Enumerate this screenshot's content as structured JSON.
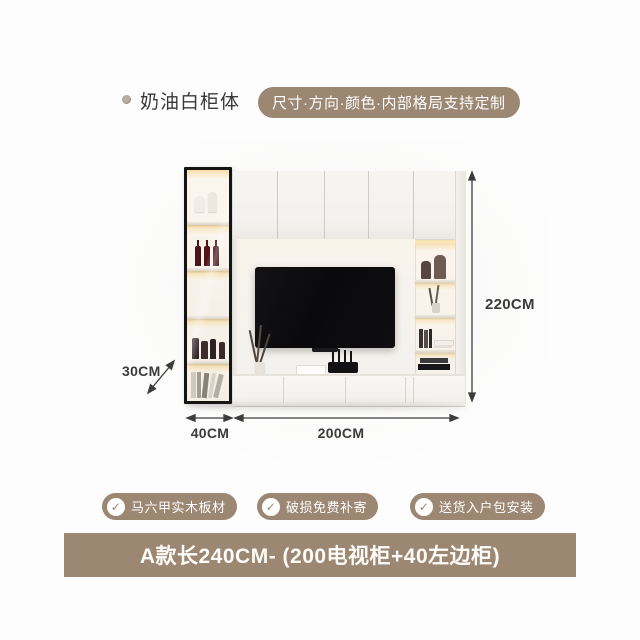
{
  "colors": {
    "accent_taupe": "#9C8773",
    "text_dark": "#3A3A3A",
    "cabinet_white": "#F6F3EE",
    "tv_black": "#0B0B0D",
    "led_glow": "#F7E0A6"
  },
  "header": {
    "product_label": "奶油白柜体",
    "customize_badge": "尺寸·方向·颜色·内部格局支持定制"
  },
  "figure": {
    "dim_height": "220CM",
    "dim_depth": "30CM",
    "dim_left_cabinet_width": "40CM",
    "dim_tv_cabinet_width": "200CM"
  },
  "features": [
    "马六甲实木板材",
    "破损免费补寄",
    "送货入户包安装"
  ],
  "icons": {
    "check": "✓",
    "bullet": "dot"
  },
  "footer": {
    "variant_title": "A款长240CM- (200电视柜+40左边柜)"
  }
}
